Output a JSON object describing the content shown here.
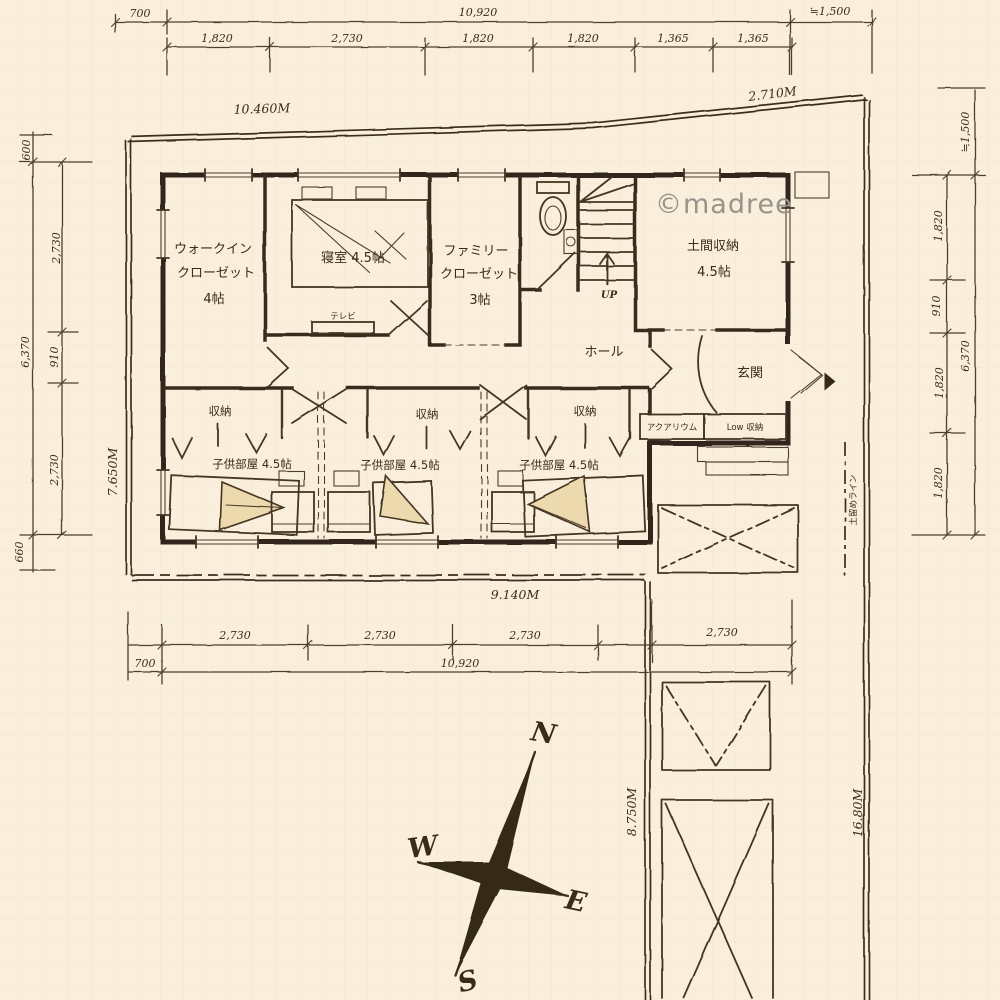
{
  "meta": {
    "watermark": "©madree"
  },
  "colors": {
    "paper": "#f9efdc",
    "ink": "#3a2c18",
    "wall": "#33271a",
    "watermark": "#97948c",
    "bed_fill": "#ecd9ad"
  },
  "compass": {
    "north": "N",
    "east": "E",
    "south": "S",
    "west": "W"
  },
  "dim_top": {
    "offset": "700",
    "total": "10,920",
    "approx_right": "≒1,500",
    "segments": [
      "1,820",
      "2,730",
      "1,820",
      "1,820",
      "1,365",
      "1,365"
    ]
  },
  "dim_left": {
    "top": "600",
    "total": "6,370",
    "bottom": "660",
    "segments": [
      "2,730",
      "910",
      "2,730"
    ]
  },
  "dim_right": {
    "approx_top": "≒1,500",
    "total": "6,370",
    "segments": [
      "1,820",
      "910",
      "1,820",
      "1,820"
    ]
  },
  "dim_bottom": {
    "segments": [
      "2,730",
      "2,730",
      "2,730",
      "2,730"
    ],
    "offset": "700",
    "total": "10,920"
  },
  "site": {
    "edge_top": "10.460M",
    "edge_top_right": "2.710M",
    "edge_left": "7.650M",
    "edge_bottom": "9.140M",
    "edge_inner_right": "8.750M",
    "edge_right": "16.80M",
    "retaining_line": "土留めライン"
  },
  "rooms": {
    "wic_line1": "ウォークイン",
    "wic_line2": "クローゼット",
    "wic_size": "4帖",
    "bedroom": "寝室 4.5帖",
    "fc_line1": "ファミリー",
    "fc_line2": "クローゼット",
    "fc_size": "3帖",
    "doma": "土間収納",
    "doma_size": "4.5帖",
    "hall": "ホール",
    "genkan": "玄関",
    "up": "UP",
    "tv": "テレビ",
    "storage": "収納",
    "kids": "子供部屋 4.5帖",
    "aquarium": "アクアリウム",
    "low_storage": "Low 収納"
  }
}
